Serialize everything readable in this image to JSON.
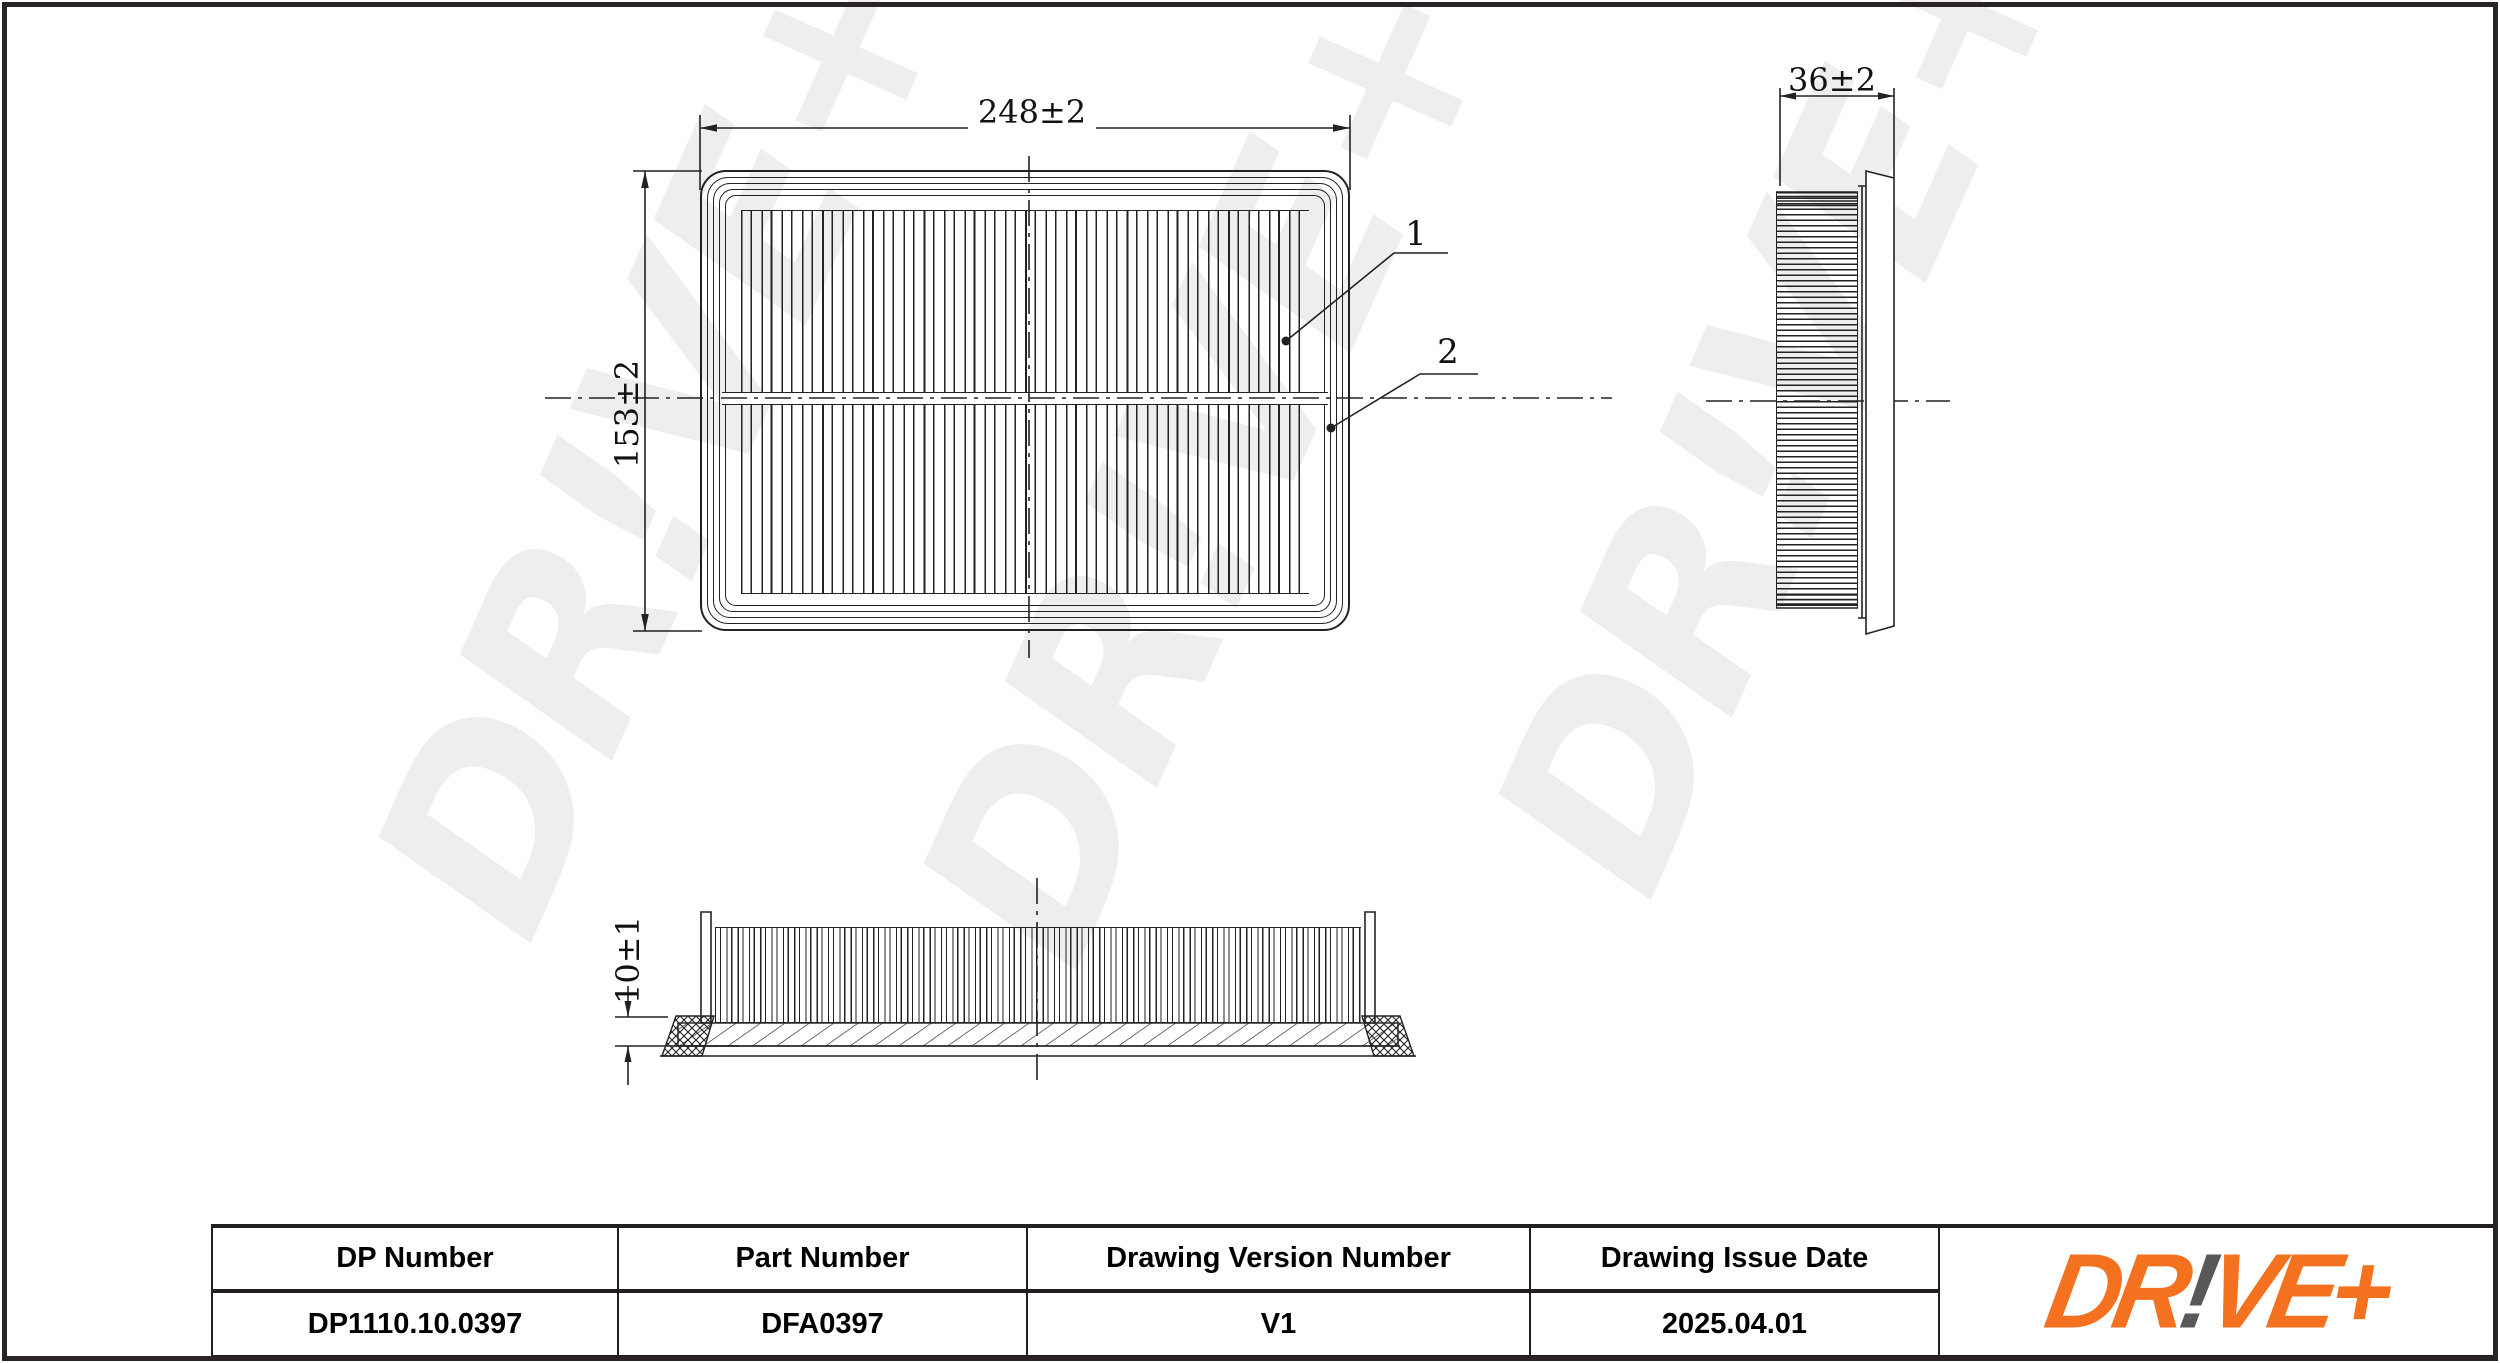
{
  "sheet": {
    "background": "#ffffff",
    "border_color": "#2b2424"
  },
  "colors": {
    "line": "#222222",
    "watermark": "#eeeeee",
    "logo_orange": "#F4711F",
    "logo_gray": "#58585A",
    "table_line": "#231f20",
    "text": "#111111"
  },
  "watermark": {
    "text": "DR!VE+"
  },
  "views": {
    "top": {
      "width_dim": "248±2",
      "height_dim": "153±2",
      "callouts": [
        {
          "label": "1"
        },
        {
          "label": "2"
        }
      ]
    },
    "side": {
      "width_dim": "36±2"
    },
    "front": {
      "height_dim": "10±1"
    }
  },
  "table": {
    "headers": [
      "DP Number",
      "Part Number",
      "Drawing Version Number",
      "Drawing Issue Date"
    ],
    "values": [
      "DP1110.10.0397",
      "DFA0397",
      "V1",
      "2025.04.01"
    ]
  },
  "logo": {
    "part1": "DR",
    "part2": "!",
    "part3": "VE+"
  }
}
